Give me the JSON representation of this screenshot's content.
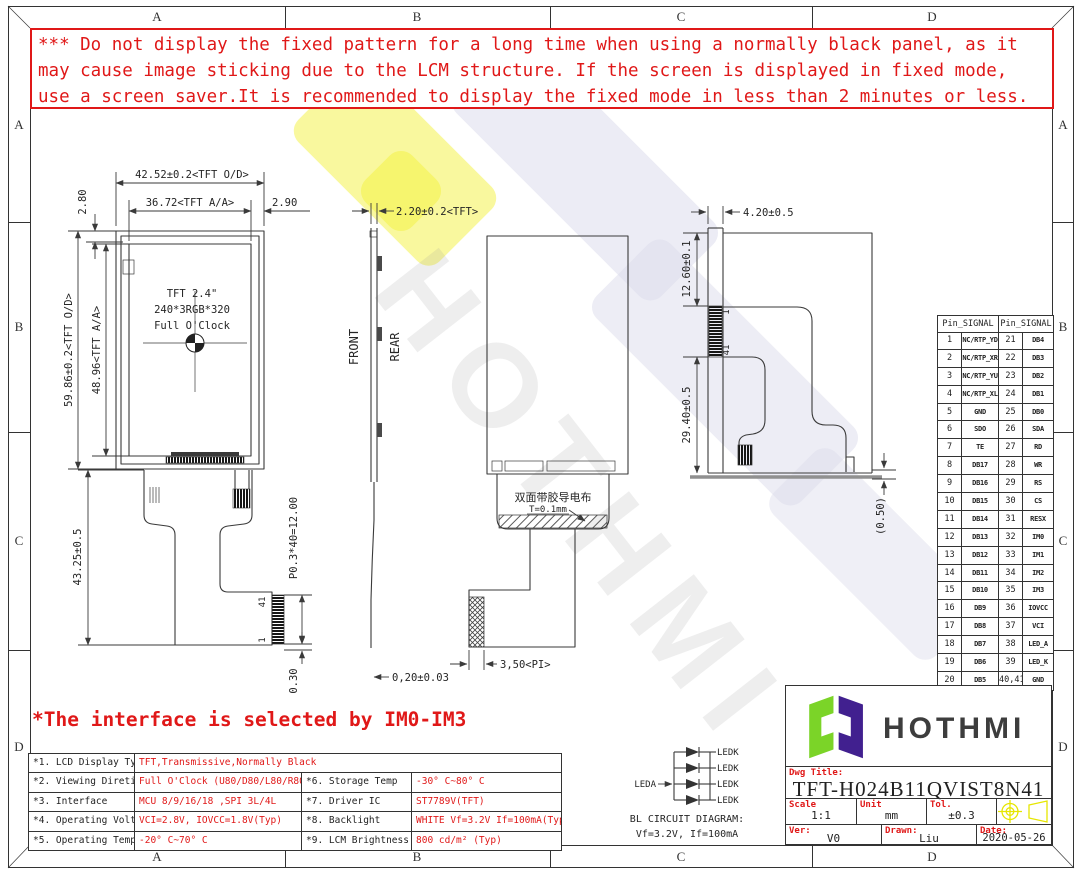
{
  "frame": {
    "cols": [
      "A",
      "B",
      "C",
      "D"
    ],
    "rows": [
      "A",
      "B",
      "C",
      "D"
    ]
  },
  "warning": {
    "line1": "*** Do not display the fixed pattern for a long time when using a normally black panel, as it",
    "line2": " may cause image sticking due to the LCM structure. If the screen is displayed in fixed mode,",
    "line3": " use a screen saver.It is recommended to display the fixed mode in less than 2 minutes or less."
  },
  "note": "*The interface is selected by IM0-IM3",
  "watermark": {
    "text": "HOTHMI"
  },
  "front_view": {
    "dim_width_od": "42.52±0.2<TFT O/D>",
    "dim_width_aa": "36.72<TFT A/A>",
    "dim_right_margin": "2.90",
    "dim_top_margin": "2.80",
    "dim_height_od": "59.86±0.2<TFT O/D>",
    "dim_height_aa": "48.96<TFT A/A>",
    "dim_fpc_length": "43.25±0.5",
    "dim_pin_pitch": "P0.3*40=12.00",
    "dim_tail": "0.30",
    "panel_line1": "TFT 2.4\"",
    "panel_line2": "240*3RGB*320",
    "panel_line3": "Full O'Clock",
    "pin_end": "41",
    "pin_start": "1"
  },
  "side_view": {
    "dim_thickness": "2.20±0.2<TFT>",
    "label_front": "FRONT",
    "label_rear": "REAR",
    "dim_fpc_thickness": "0,20±0.03"
  },
  "rear_view": {
    "cloth_text": "双面带胶导电布",
    "cloth_thickness": "T=0.1mm",
    "dim_stiffener": "3,50<PI>"
  },
  "fold_view": {
    "dim_fpc_width": "4.20±0.5",
    "dim_top_offset": "12.60±0.1",
    "dim_bottom_offset": "29.40±0.5",
    "dim_tape": "(0.50)",
    "pin_start": "1",
    "pin_end": "41"
  },
  "pin_table": {
    "header": "Pin_SIGNAL",
    "rows": [
      [
        "1",
        "NC/RTP_YD",
        "21",
        "DB4"
      ],
      [
        "2",
        "NC/RTP_XR",
        "22",
        "DB3"
      ],
      [
        "3",
        "NC/RTP_YU",
        "23",
        "DB2"
      ],
      [
        "4",
        "NC/RTP_XL",
        "24",
        "DB1"
      ],
      [
        "5",
        "GND",
        "25",
        "DB0"
      ],
      [
        "6",
        "SDO",
        "26",
        "SDA"
      ],
      [
        "7",
        "TE",
        "27",
        "RD"
      ],
      [
        "8",
        "DB17",
        "28",
        "WR"
      ],
      [
        "9",
        "DB16",
        "29",
        "RS"
      ],
      [
        "10",
        "DB15",
        "30",
        "CS"
      ],
      [
        "11",
        "DB14",
        "31",
        "RESX"
      ],
      [
        "12",
        "DB13",
        "32",
        "IM0"
      ],
      [
        "13",
        "DB12",
        "33",
        "IM1"
      ],
      [
        "14",
        "DB11",
        "34",
        "IM2"
      ],
      [
        "15",
        "DB10",
        "35",
        "IM3"
      ],
      [
        "16",
        "DB9",
        "36",
        "IOVCC"
      ],
      [
        "17",
        "DB8",
        "37",
        "VCI"
      ],
      [
        "18",
        "DB7",
        "38",
        "LED_A"
      ],
      [
        "19",
        "DB6",
        "39",
        "LED_K"
      ],
      [
        "20",
        "DB5",
        "40,41",
        "GND"
      ]
    ]
  },
  "spec_table": {
    "r1_label": "*1. LCD Display Type",
    "r1_value": "TFT,Transmissive,Normally Black",
    "r2_label": "*2. Viewing Diretion",
    "r2_value": "Full O'Clock (U80/D80/L80/R80)",
    "r2_label2": "*6. Storage Temp",
    "r2_value2": "-30° C~80° C",
    "r3_label": "*3. Interface",
    "r3_value": "MCU 8/9/16/18 ,SPI 3L/4L",
    "r3_label2": "*7. Driver IC",
    "r3_value2": "ST7789V(TFT)",
    "r4_label": "*4. Operating Voltage",
    "r4_value": "VCI=2.8V, IOVCC=1.8V(Typ)",
    "r4_label2": "*8. Backlight",
    "r4_value2": "WHITE Vf=3.2V If=100mA(Typ)",
    "r5_label": "*5. Operating Temp",
    "r5_value": "-20° C~70° C",
    "r5_label2": "*9. LCM Brightness",
    "r5_value2": "800 cd/m² (Typ)"
  },
  "bl_circuit": {
    "anode": "LEDA",
    "cathode": "LEDK",
    "caption1": "BL CIRCUIT DIAGRAM:",
    "caption2": "Vf=3.2V, If=100mA"
  },
  "title_block": {
    "brand": "HOTHMI",
    "dwg_title_label": "Dwg Title:",
    "dwg_title": "TFT-H024B11QVIST8N41",
    "scale_label": "Scale",
    "scale_value": "1:1",
    "unit_label": "Unit",
    "unit_value": "mm",
    "tol_label": "Tol.",
    "tol_value": "±0.3",
    "ver_label": "Ver:",
    "ver_value": "V0",
    "drawn_label": "Drawn:",
    "drawn_value": "Liu",
    "date_label": "Date:",
    "date_value": "2020-05-26"
  },
  "colors": {
    "red": "#e01818",
    "line": "#3a3a3a",
    "logo_green": "#7bd428",
    "logo_purple": "#41208f",
    "projection_yellow": "#e6e600",
    "watermark_yellow": "#f4f23e",
    "watermark_lavender": "#dcdcec"
  }
}
